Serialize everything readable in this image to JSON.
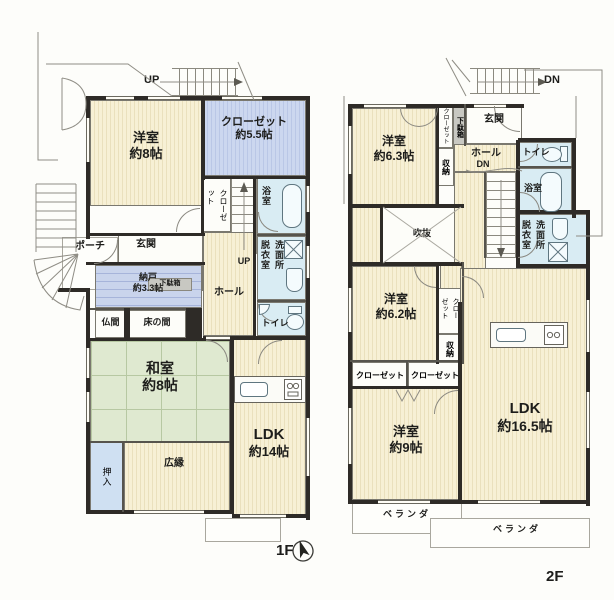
{
  "floor1": {
    "label": "1F",
    "stairs_up_outside": "UP",
    "stairs_up_inside": "UP",
    "rooms": {
      "youshitsu8": {
        "name": "洋室",
        "size": "約8帖"
      },
      "closet55": {
        "name": "クローゼット",
        "size": "約5.5帖"
      },
      "closet_side": "クローゼット",
      "bath": "浴室",
      "datsui": "脱衣室",
      "senmen": "洗面所",
      "toilet": "トイレ",
      "porch": "ポーチ",
      "genkan": "玄関",
      "getabako": "下駄箱",
      "nando": {
        "name": "納戸",
        "size": "約3.3帖"
      },
      "hall": "ホール",
      "butsuma": "仏間",
      "tokonoma": "床の間",
      "washitsu": {
        "name": "和室",
        "size": "約8帖"
      },
      "oshiire": "押入",
      "hiroen": "広縁",
      "ldk": {
        "name": "LDK",
        "size": "約14帖"
      }
    }
  },
  "floor2": {
    "label": "2F",
    "stairs_dn_outside": "DN",
    "stairs_dn_inside": "DN",
    "rooms": {
      "youshitsu63": {
        "name": "洋室",
        "size": "約6.3帖"
      },
      "closet_entry": "クローゼット",
      "getabako": "下駄箱",
      "genkan": "玄関",
      "shuunou_entry": "収納",
      "hall": "ホール",
      "toilet": "トイレ",
      "bath": "浴室",
      "datsui": "脱衣室",
      "senmen": "洗面所",
      "fukinuke": "吹抜",
      "youshitsu62": {
        "name": "洋室",
        "size": "約6.2帖"
      },
      "closet_side": "クローゼット",
      "shuunou": "収納",
      "closet_a": "クローゼット",
      "closet_b": "クローゼット",
      "youshitsu9": {
        "name": "洋室",
        "size": "約9帖"
      },
      "ldk": {
        "name": "LDK",
        "size": "約16.5帖"
      },
      "veranda_a": "ベランダ",
      "veranda_b": "ベランダ"
    }
  },
  "colors": {
    "wall": "#2e2b27",
    "flooring": "#f6efd3",
    "flooring_stripe": "#e9dfba",
    "tatami": "#dfe9d0",
    "closet_blue": "#c9d4ec",
    "wet_area": "#d9ecf3",
    "storage_blue": "#cfe0f2"
  }
}
